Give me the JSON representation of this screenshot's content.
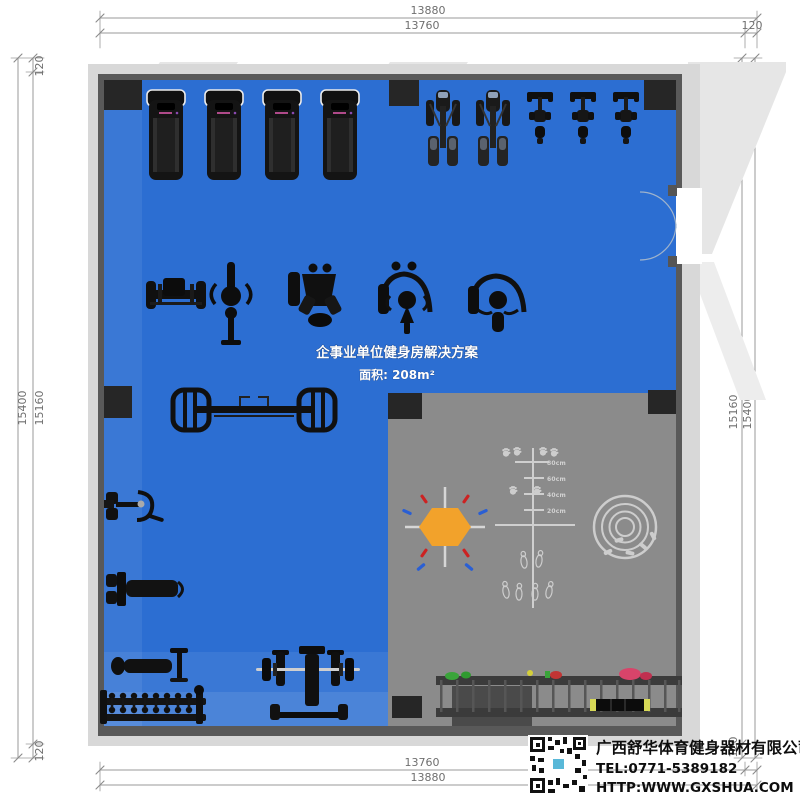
{
  "dimensions": {
    "top": {
      "outer": "13880",
      "inner": "13760",
      "wall": "120"
    },
    "bottom": {
      "inner": "13760",
      "outer": "13880"
    },
    "left": {
      "outer": "15400",
      "inner": "15160",
      "wall_top": "120",
      "wall_bottom": "120"
    },
    "right": {
      "outer": "15400",
      "inner": "15160",
      "wall_top": "120",
      "wall_bottom": "120"
    }
  },
  "plan": {
    "title": "企事业单位健身房解决方案",
    "area": "面积: 208m²",
    "floor_color": "#2c6ed2",
    "training_zone_color": "#8b8b8b",
    "wall_color": "#d8d8d8",
    "hexagon_color": "#f2a22b",
    "marking_color": "#cdcdcd",
    "accent_red": "#cc2222",
    "accent_blue": "#2a5fd4"
  },
  "training_zone": {
    "ruler_labels": [
      "80cm",
      "60cm",
      "40cm",
      "20cm"
    ]
  },
  "equipment": [
    {
      "type": "treadmill",
      "count": 4
    },
    {
      "type": "elliptical-trainer",
      "count": 2
    },
    {
      "type": "exercise-bike",
      "count": 3
    },
    {
      "type": "strength-machine",
      "count": 5
    },
    {
      "type": "dual-cable-station",
      "count": 1
    },
    {
      "type": "wall-mounted-machine",
      "count": 2
    },
    {
      "type": "adjustable-bench",
      "count": 1
    },
    {
      "type": "dumbbell-rack",
      "count": 1
    },
    {
      "type": "bench-press-rack",
      "count": 1
    },
    {
      "type": "accessory-storage-rack",
      "count": 1
    }
  ],
  "company": {
    "name": "广西舒华体育健身器材有限公司",
    "tel": "TEL:0771-5389182",
    "website": "HTTP:WWW.GXSHUA.COM"
  }
}
